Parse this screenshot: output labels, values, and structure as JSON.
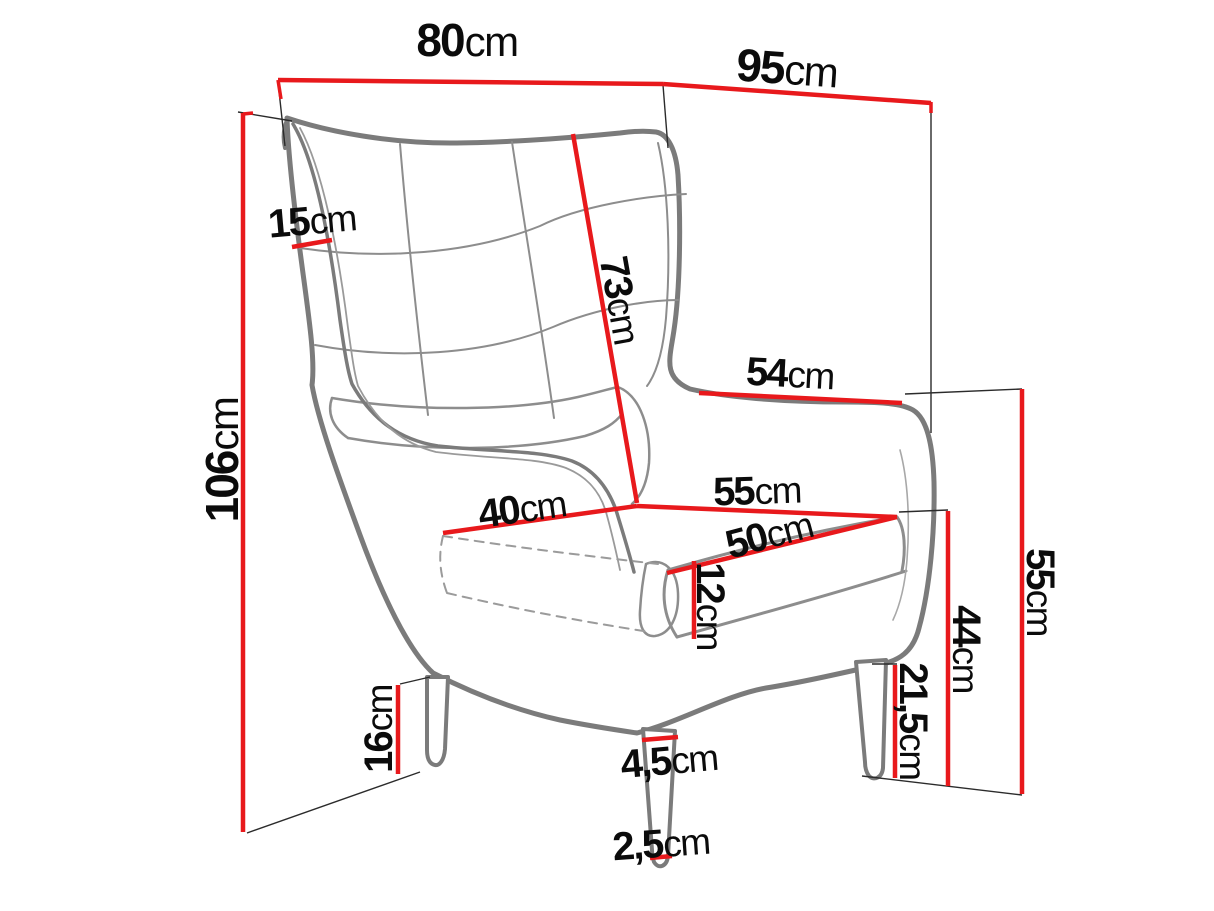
{
  "diagram": {
    "subject": "Wingback armchair line drawing with measurement lines",
    "unit": "cm",
    "accent_color": "#e8191c",
    "drawing_color": "#7b7b7b"
  },
  "dimensions": {
    "overall_width": {
      "value": "80",
      "unit": "cm"
    },
    "overall_depth": {
      "value": "95",
      "unit": "cm"
    },
    "wing_side": {
      "value": "15",
      "unit": "cm"
    },
    "overall_height": {
      "value": "106",
      "unit": "cm"
    },
    "backrest_height": {
      "value": "73",
      "unit": "cm"
    },
    "armrest_top_depth": {
      "value": "54",
      "unit": "cm"
    },
    "seat_front_width": {
      "value": "40",
      "unit": "cm"
    },
    "seat_depth": {
      "value": "55",
      "unit": "cm"
    },
    "seat_width": {
      "value": "50",
      "unit": "cm"
    },
    "cushion_height": {
      "value": "12",
      "unit": "cm"
    },
    "rear_leg_height": {
      "value": "16",
      "unit": "cm"
    },
    "front_leg_top_width": {
      "value": "4,5",
      "unit": "cm"
    },
    "front_leg_bottom_width": {
      "value": "2,5",
      "unit": "cm"
    },
    "side_base_height": {
      "value": "21,5",
      "unit": "cm"
    },
    "armrest_height": {
      "value": "44",
      "unit": "cm"
    },
    "seat_back_height": {
      "value": "55",
      "unit": "cm"
    }
  }
}
